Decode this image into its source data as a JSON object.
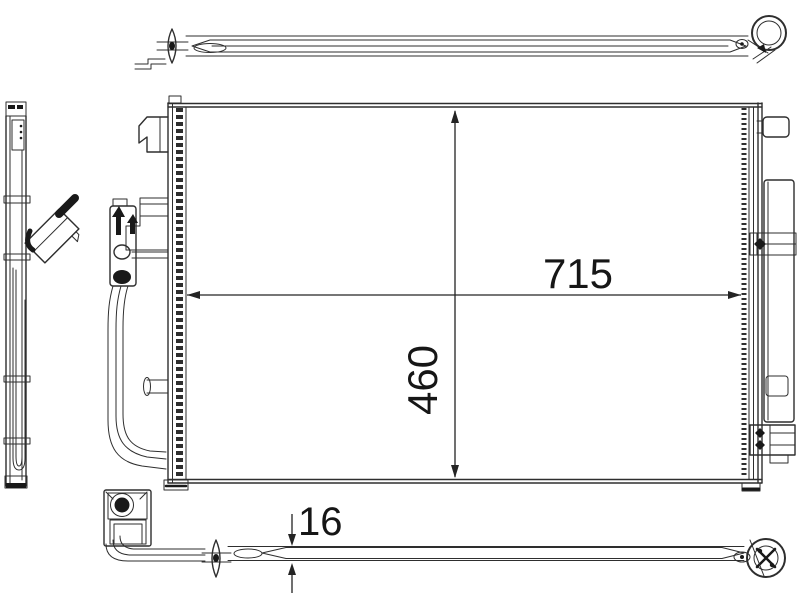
{
  "dimensions": {
    "width_label": "715",
    "height_label": "460",
    "thickness_label": "16"
  },
  "colors": {
    "line": "#2e2e2e",
    "dark_fill": "#191919",
    "background": "#ffffff"
  }
}
